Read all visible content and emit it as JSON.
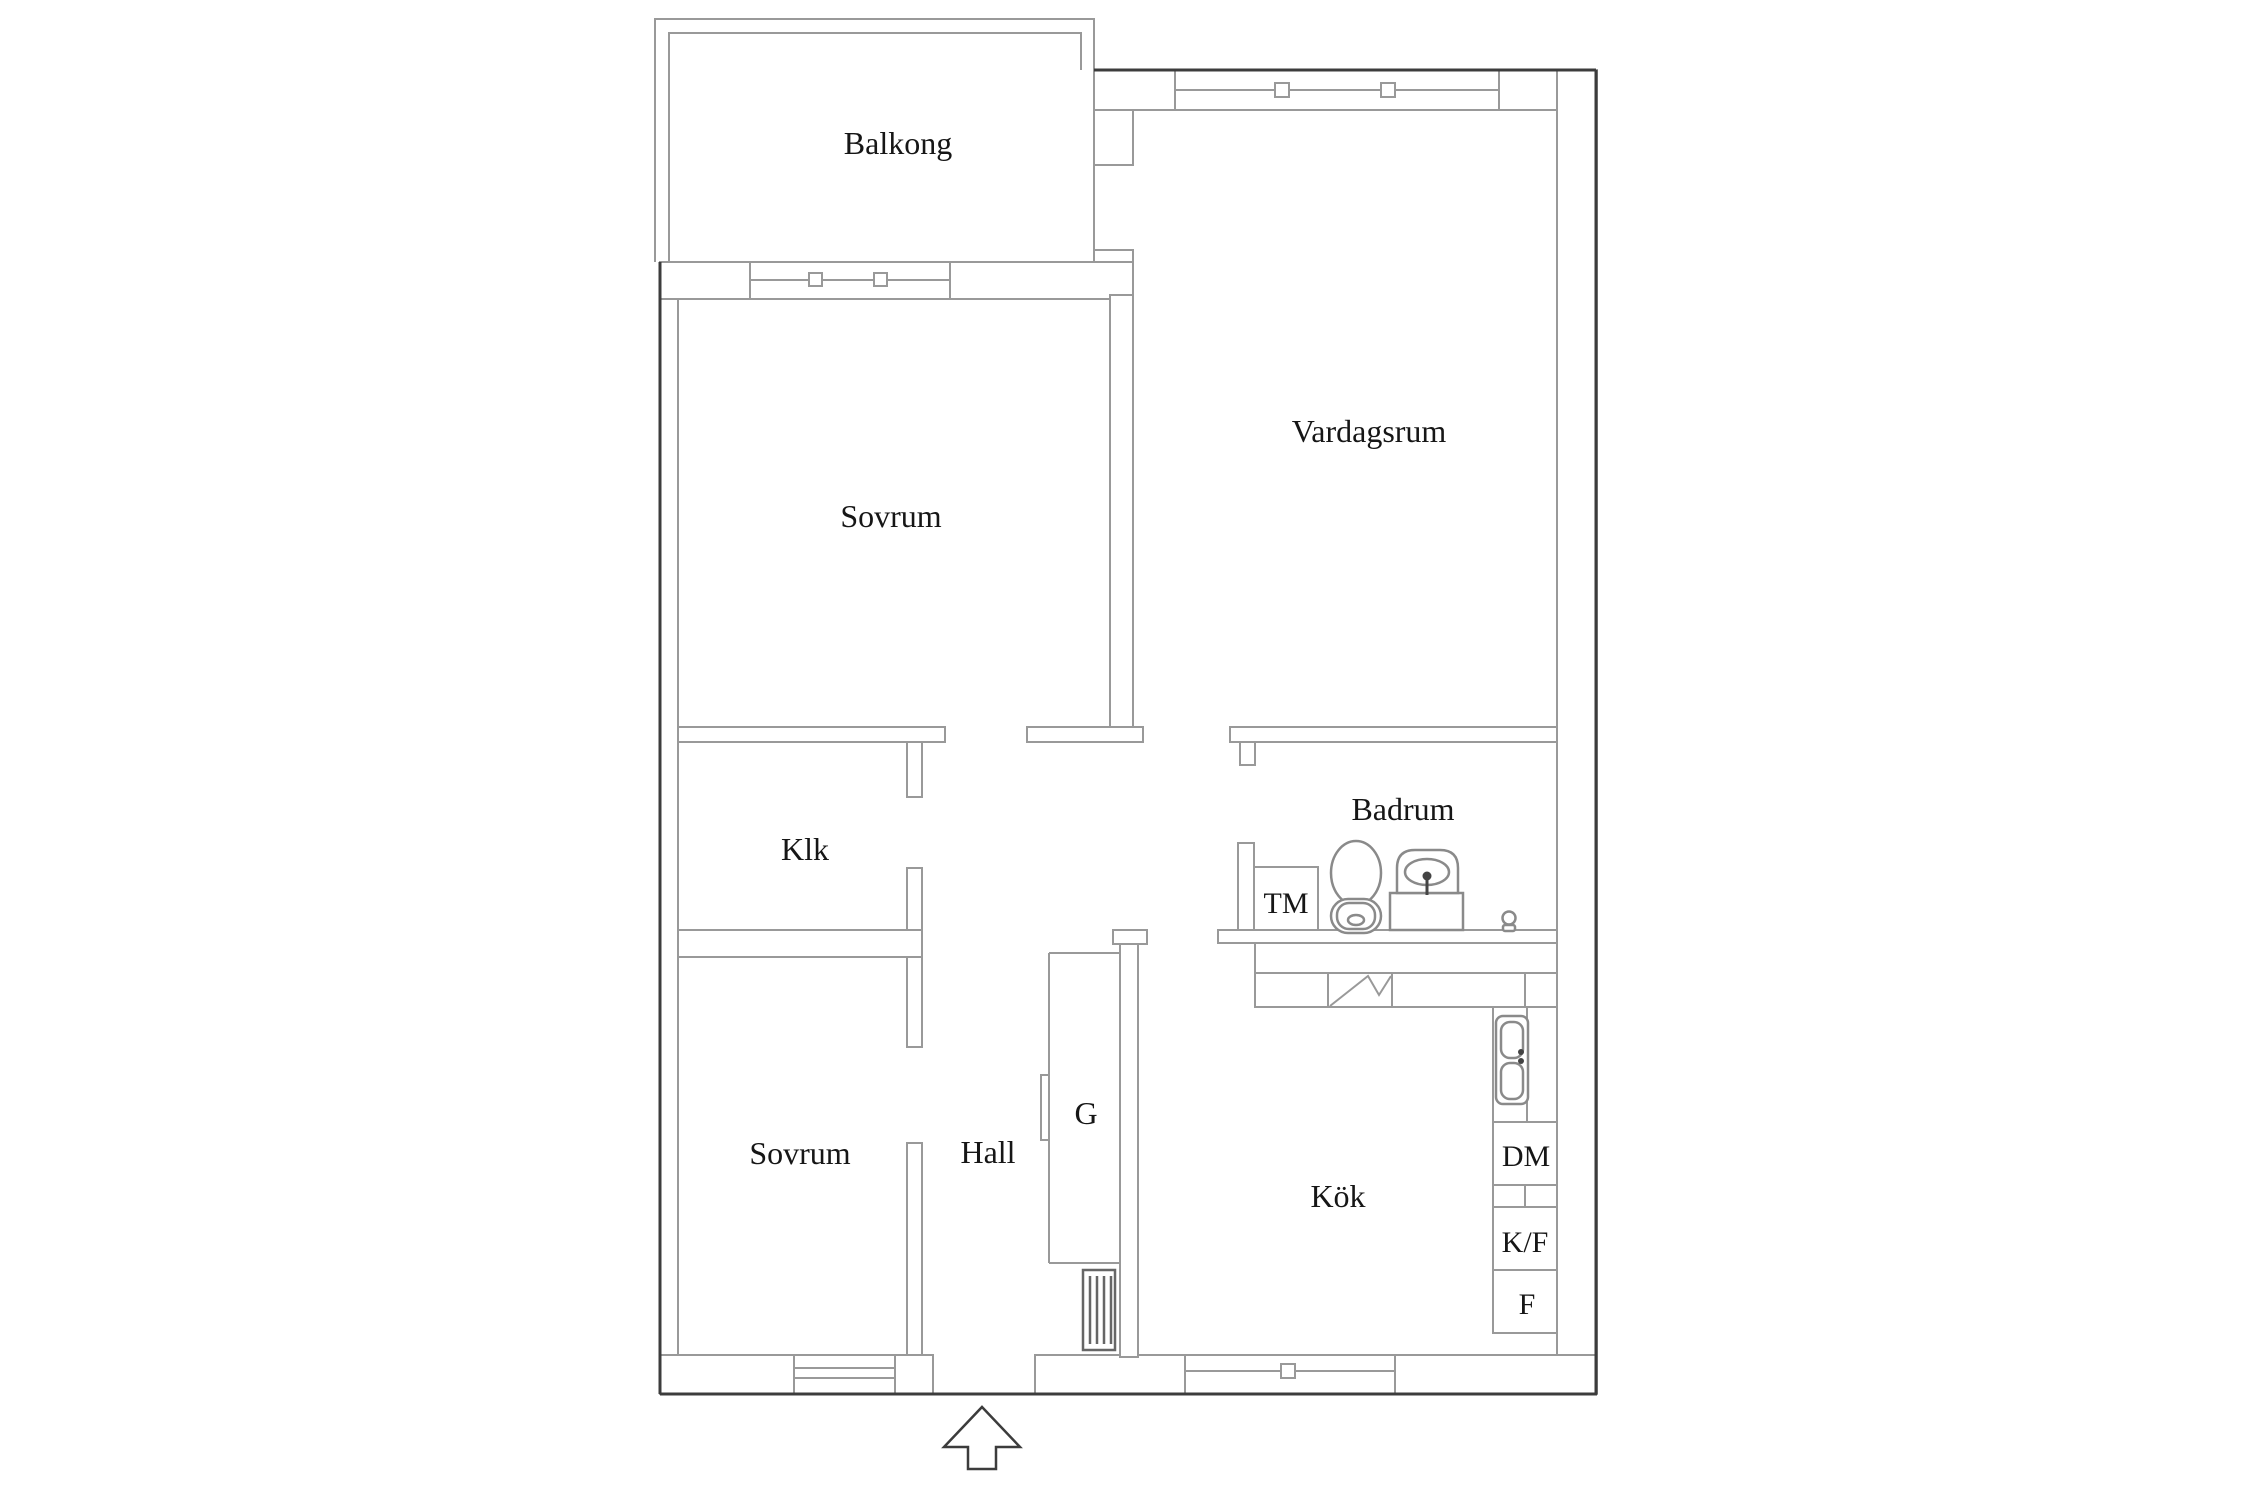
{
  "floorplan": {
    "rooms": {
      "balcony": "Balkong",
      "living_room": "Vardagsrum",
      "bedroom_top": "Sovrum",
      "closet": "Klk",
      "bathroom": "Badrum",
      "washing_machine": "TM",
      "bedroom_bottom": "Sovrum",
      "hall": "Hall",
      "wardrobe": "G",
      "kitchen": "Kök",
      "dishwasher": "DM",
      "fridge_freezer": "K/F",
      "freezer": "F"
    },
    "icons": {
      "entrance_arrow": "entrance-arrow",
      "window_marker": "window-marker",
      "radiator": "radiator",
      "toilet": "toilet",
      "bathroom_sink": "bathroom-sink",
      "floor_drain": "floor-drain",
      "kitchen_sink": "double-kitchen-sink",
      "stove": "stove-symbol",
      "sliding_door": "wardrobe-sliding-door"
    },
    "colors": {
      "background": "#ffffff",
      "outer_wall": "#3c3c3c",
      "inner_wall": "#999999",
      "text": "#161616"
    }
  }
}
